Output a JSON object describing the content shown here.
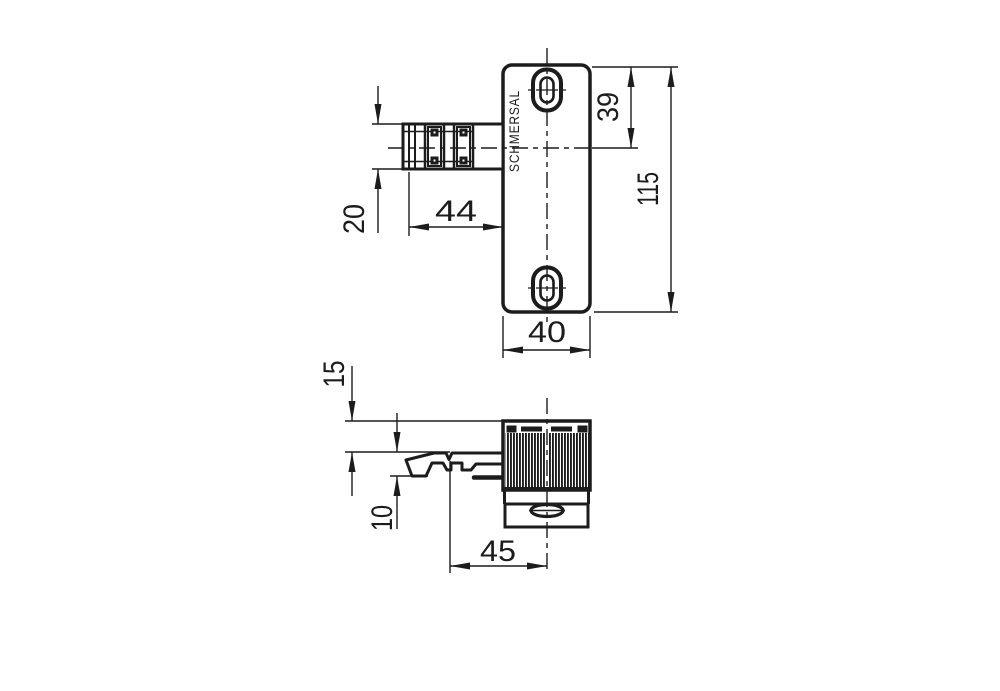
{
  "title": "Schmersal safety sensor dimensional drawing",
  "brand_label": "SCHMERSAL",
  "dims": {
    "connector_height": "20",
    "connector_length": "44",
    "hole_offset": "39",
    "body_height": "115",
    "body_width": "40",
    "side_top": "15",
    "side_actuator": "10",
    "side_offset": "45"
  },
  "line_color": "#1c1c1c",
  "background_color": "#ffffff"
}
